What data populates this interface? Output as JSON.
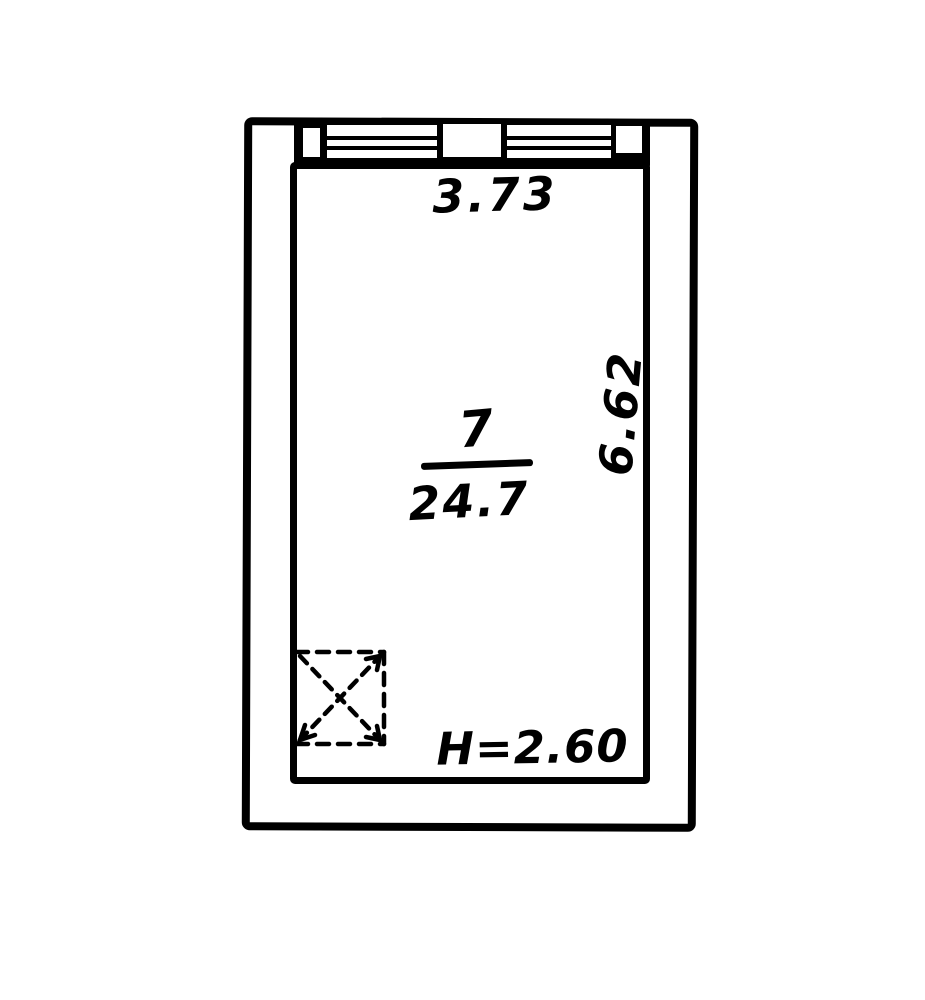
{
  "plan": {
    "labels": {
      "width": "3.73",
      "room_number": "7",
      "area": "24.7",
      "depth": "6.62",
      "ceiling_height": "H=2.60"
    },
    "colors": {
      "ink": "#000000",
      "paper": "#ffffff"
    },
    "symbols": {
      "window_icon": "double-glazed-window-lines",
      "shaft_icon": "dashed-box-with-crossed-arrows"
    }
  }
}
